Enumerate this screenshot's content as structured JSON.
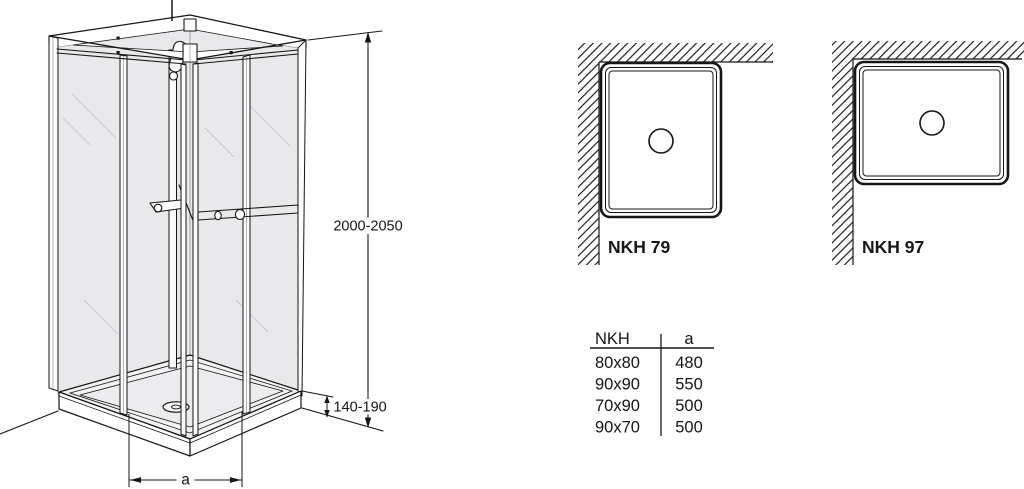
{
  "drawing_type": "shower cabin technical dimension drawing",
  "colors": {
    "line": "#161616",
    "glass_fill": "#e9e9ec",
    "tray_fill": "#f2f2f5",
    "background": "#ffffff"
  },
  "main_drawing": {
    "description": "corner-entry shower cabin, isometric view",
    "height_range": "2000-2050",
    "tray_height_range": "140-190",
    "width_label": "a"
  },
  "plan_views": [
    {
      "id": "nkh-79",
      "label": "NKH 79"
    },
    {
      "id": "nkh-97",
      "label": "NKH 97"
    }
  ],
  "size_table": {
    "headers": [
      "NKH",
      "a"
    ],
    "rows": [
      {
        "size": "80x80",
        "a": "480"
      },
      {
        "size": "90x90",
        "a": "550"
      },
      {
        "size": "70x90",
        "a": "500"
      },
      {
        "size": "90x70",
        "a": "500"
      }
    ]
  }
}
